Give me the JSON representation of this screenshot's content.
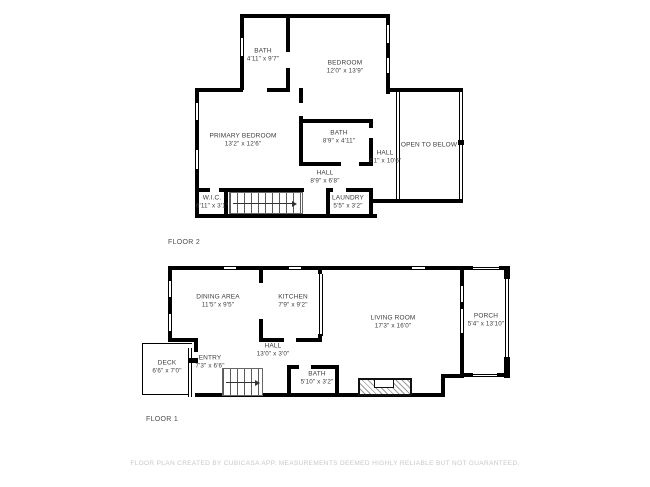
{
  "colors": {
    "wall": "#000000",
    "room_text": "#3c3c3c",
    "floor_label_text": "#4d4d4d",
    "footer_text": "#c8c8c8",
    "background": "#ffffff"
  },
  "footer": {
    "text": "FLOOR PLAN CREATED BY CUBICASA APP. MEASUREMENTS DEEMED HIGHLY RELIABLE BUT NOT GUARANTEED."
  },
  "floor2": {
    "label": "FLOOR 2",
    "rooms": [
      {
        "name": "BATH",
        "dims": "4'11\" x 9'7\""
      },
      {
        "name": "BEDROOM",
        "dims": "12'0\" x 13'9\""
      },
      {
        "name": "PRIMARY BEDROOM",
        "dims": "13'2\" x 12'6\""
      },
      {
        "name": "BATH",
        "dims": "8'9\" x 4'11\""
      },
      {
        "name": "HALL",
        "dims": "4'1\" x 10'6\""
      },
      {
        "name": "OPEN TO BELOW",
        "dims": ""
      },
      {
        "name": "HALL",
        "dims": "8'9\" x 6'8\""
      },
      {
        "name": "W.I.C.",
        "dims": "6'11\" x 3'1\""
      },
      {
        "name": "LAUNDRY",
        "dims": "5'5\" x 3'2\""
      }
    ]
  },
  "floor1": {
    "label": "FLOOR 1",
    "rooms": [
      {
        "name": "DINING AREA",
        "dims": "11'5\" x 9'5\""
      },
      {
        "name": "KITCHEN",
        "dims": "7'9\" x 9'2\""
      },
      {
        "name": "LIVING ROOM",
        "dims": "17'3\" x 16'0\""
      },
      {
        "name": "PORCH",
        "dims": "5'4\" x 13'10\""
      },
      {
        "name": "HALL",
        "dims": "13'0\" x 3'0\""
      },
      {
        "name": "DECK",
        "dims": "6'6\" x 7'0\""
      },
      {
        "name": "ENTRY",
        "dims": "7'3\" x 6'6\""
      },
      {
        "name": "BATH",
        "dims": "5'10\" x 3'2\""
      }
    ]
  }
}
